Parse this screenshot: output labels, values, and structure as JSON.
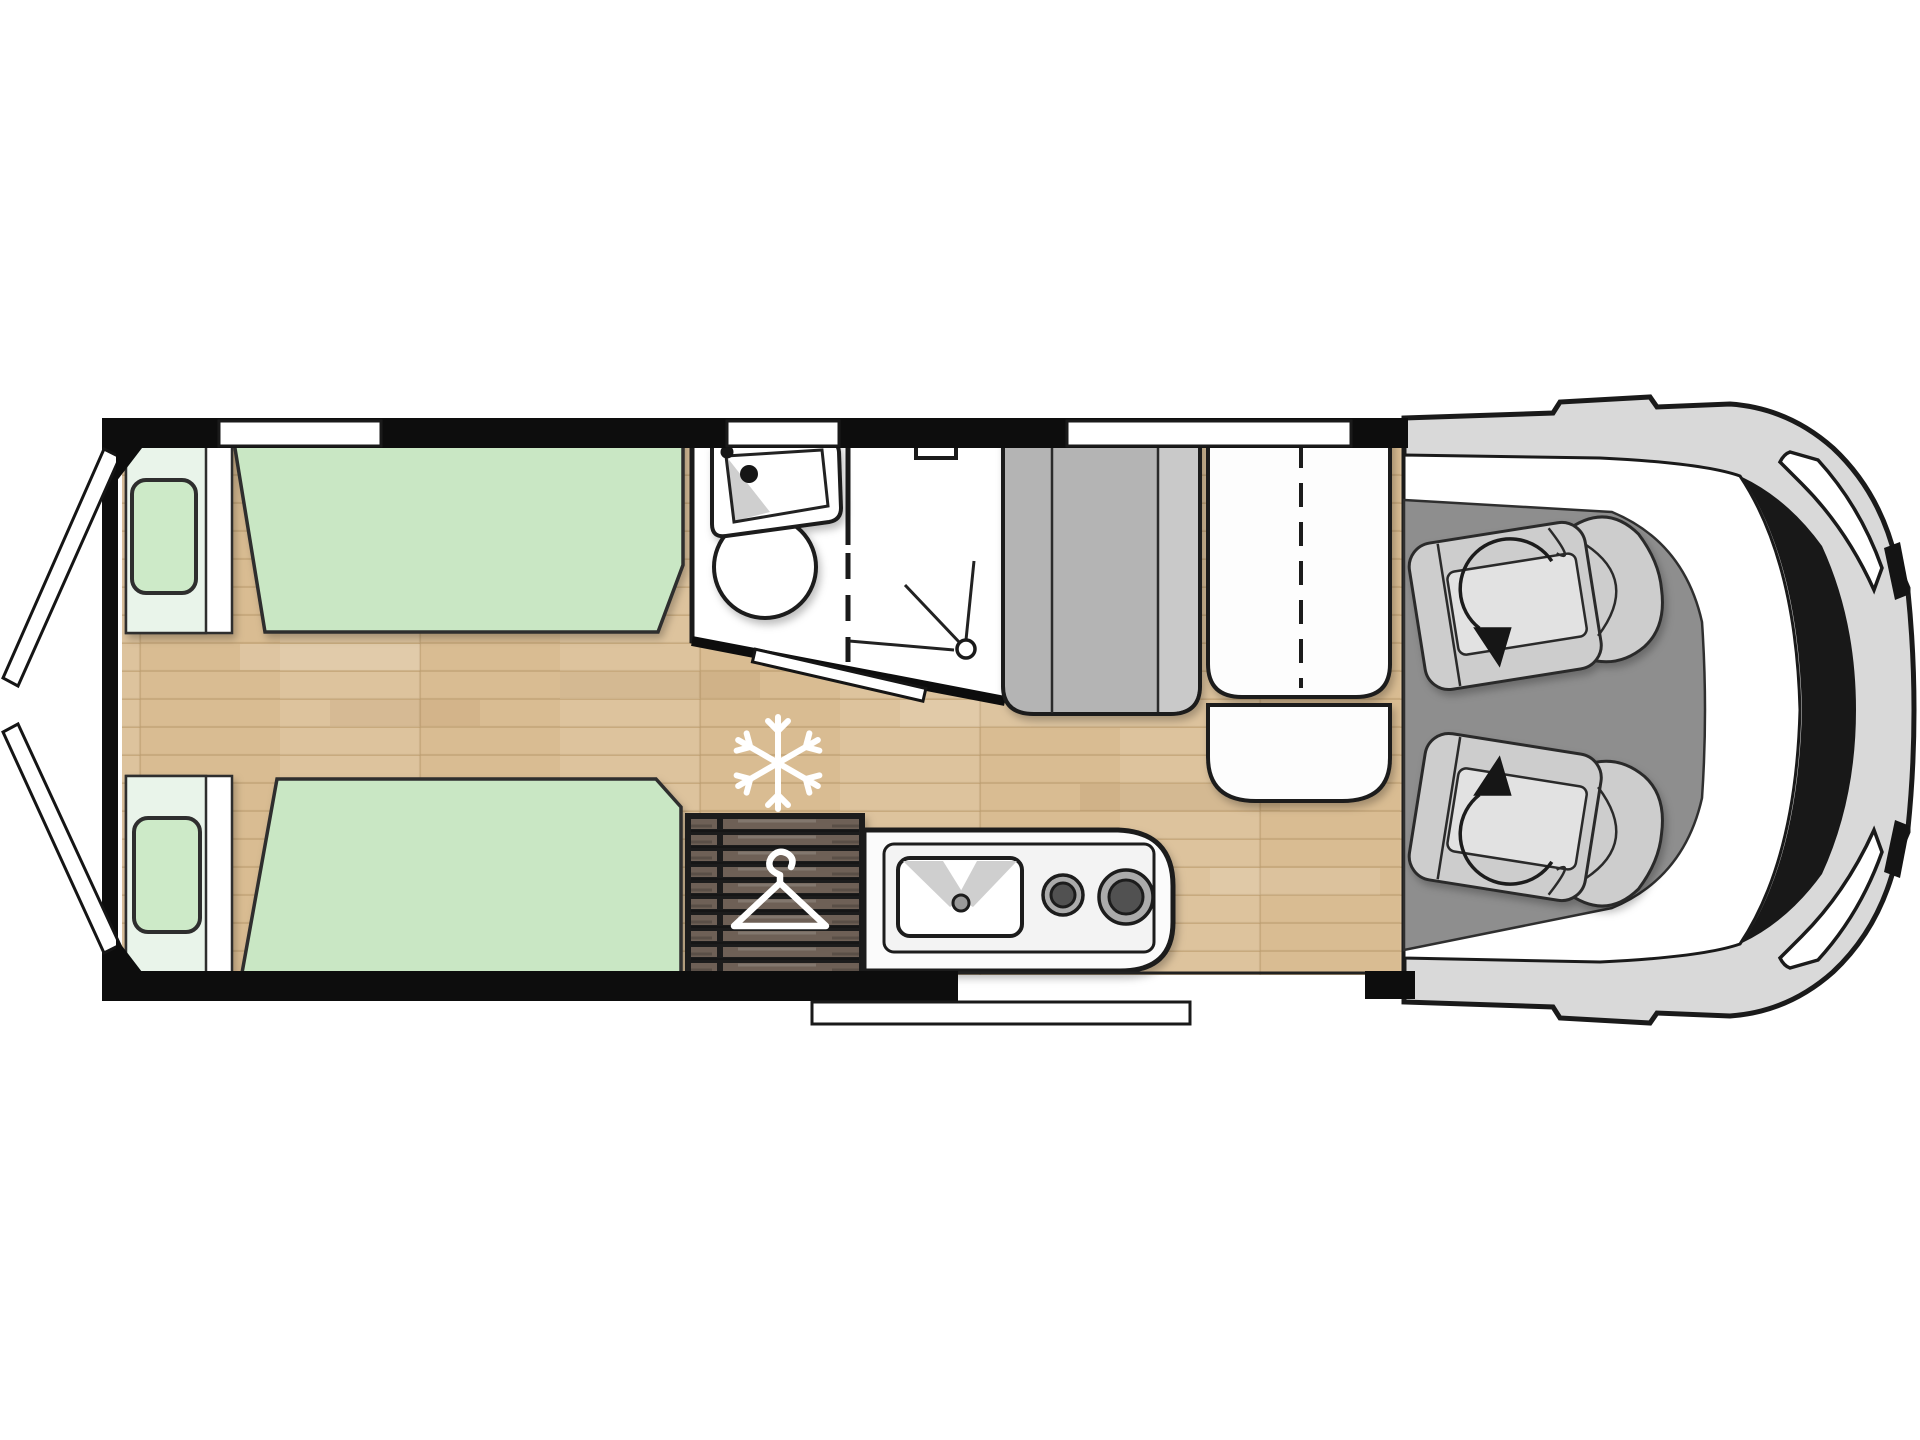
{
  "scene": {
    "description": "Top-down illustrated floor plan of a campervan / motorhome, no visible text labels",
    "background": "#ffffff"
  },
  "colors": {
    "outline": "#1a1a1a",
    "outline_soft": "#2e2e2e",
    "wall": "#0d0d0d",
    "floor": "#d9bc92",
    "floor_line": "#b99a6d",
    "mattress": "#c9e7c4",
    "pillow": "#cdeac8",
    "headboard": "#e9f4ea",
    "wardrobe": "#6e6156",
    "cab_floor": "#8e8e8e",
    "bench": "#b4b4b4",
    "bench_light": "#c9c9c9",
    "body": "#d9d9d9",
    "windshield": "#181818",
    "seat": "#cdcdcd",
    "seat_light": "#e2e2e2",
    "white": "#ffffff",
    "hob_ring": "#ababab",
    "hob_center": "#515151",
    "sink_shade": "#cfcfcf"
  },
  "icons": [
    {
      "name": "snowflake-icon",
      "meaning": "refrigerator position on floor",
      "color": "#ffffff"
    },
    {
      "name": "hanger-icon",
      "meaning": "wardrobe",
      "color": "#ffffff"
    },
    {
      "name": "shower-head-icon",
      "meaning": "shower corner",
      "color": "#1a1a1a"
    },
    {
      "name": "swivel-arrow-icon",
      "meaning": "rotating cab seat",
      "color": "#141414"
    }
  ],
  "features": {
    "windows": 3,
    "rear_single_beds": 2,
    "bed_pillows": 2,
    "cab_swivel_seats": 2,
    "hob_burners": 2,
    "kitchen_sink": 1,
    "bathroom_sink": 1,
    "toilet": 1,
    "rear_doors_open": 2,
    "entry_step": 1,
    "rooms": [
      "rear-twin-bedroom",
      "washroom-with-shower",
      "wardrobe",
      "kitchen",
      "dinette",
      "driver-cab"
    ]
  }
}
